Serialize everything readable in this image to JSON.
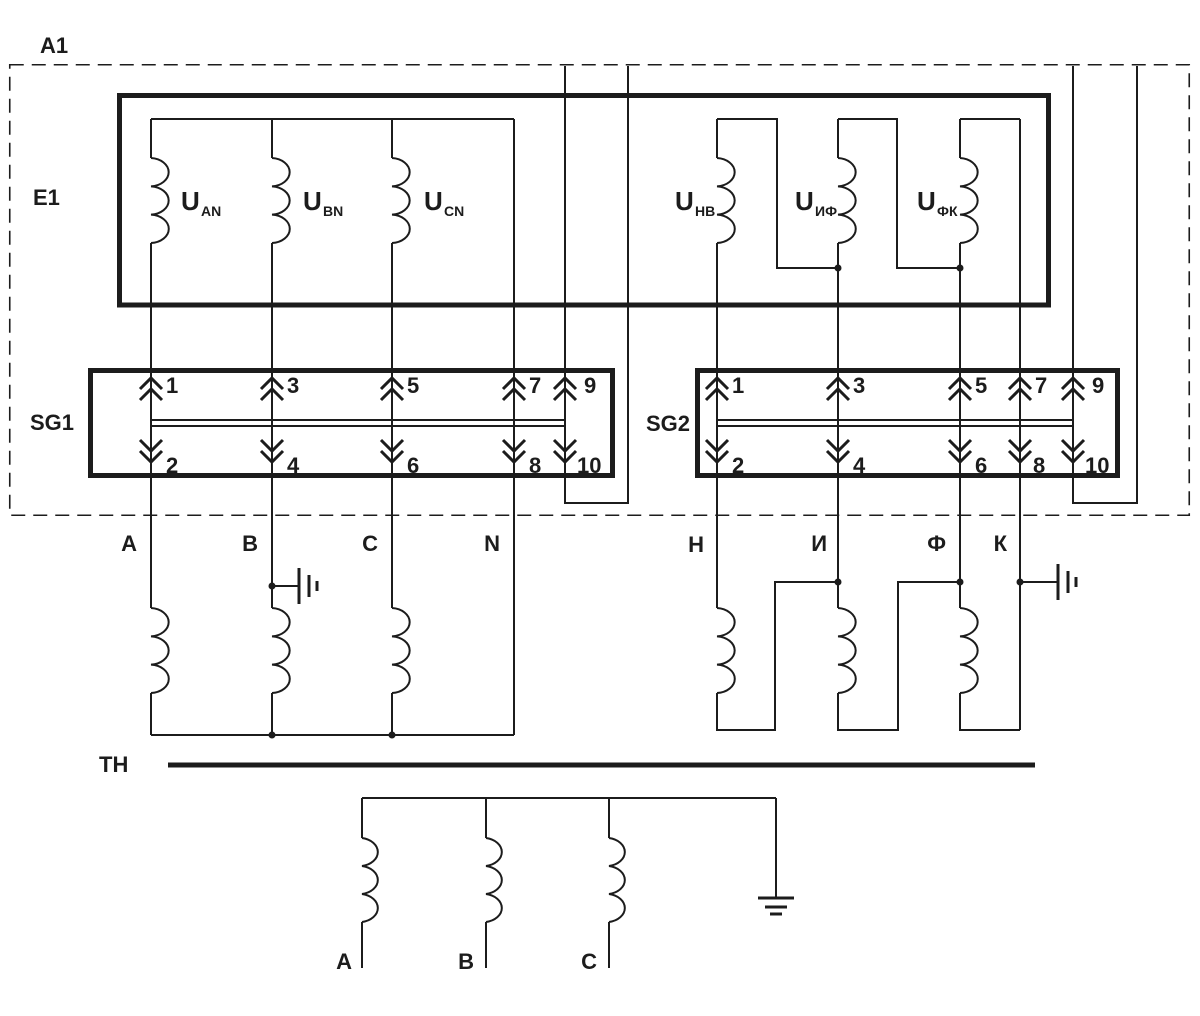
{
  "a1": {
    "label": "A1"
  },
  "e1": {
    "label": "E1",
    "phase_windings": [
      {
        "base": "U",
        "sub": "AN"
      },
      {
        "base": "U",
        "sub": "BN"
      },
      {
        "base": "U",
        "sub": "CN"
      }
    ],
    "aux_windings": [
      {
        "base": "U",
        "sub": "НВ"
      },
      {
        "base": "U",
        "sub": "ИФ"
      },
      {
        "base": "U",
        "sub": "ФК"
      }
    ]
  },
  "sg1": {
    "label": "SG1",
    "odd": [
      "1",
      "3",
      "5",
      "7",
      "9"
    ],
    "even": [
      "2",
      "4",
      "6",
      "8",
      "10"
    ]
  },
  "sg2": {
    "label": "SG2",
    "odd": [
      "1",
      "3",
      "5",
      "7",
      "9"
    ],
    "even": [
      "2",
      "4",
      "6",
      "8",
      "10"
    ]
  },
  "bus_labels": {
    "left": [
      "A",
      "B",
      "C",
      "N"
    ],
    "right": [
      "Н",
      "И",
      "Ф",
      "К"
    ]
  },
  "tn": {
    "label": "ТН",
    "phases": [
      "А",
      "В",
      "С"
    ]
  },
  "colors": {
    "ink": "#1c1c1c",
    "paper": "#ffffff"
  }
}
